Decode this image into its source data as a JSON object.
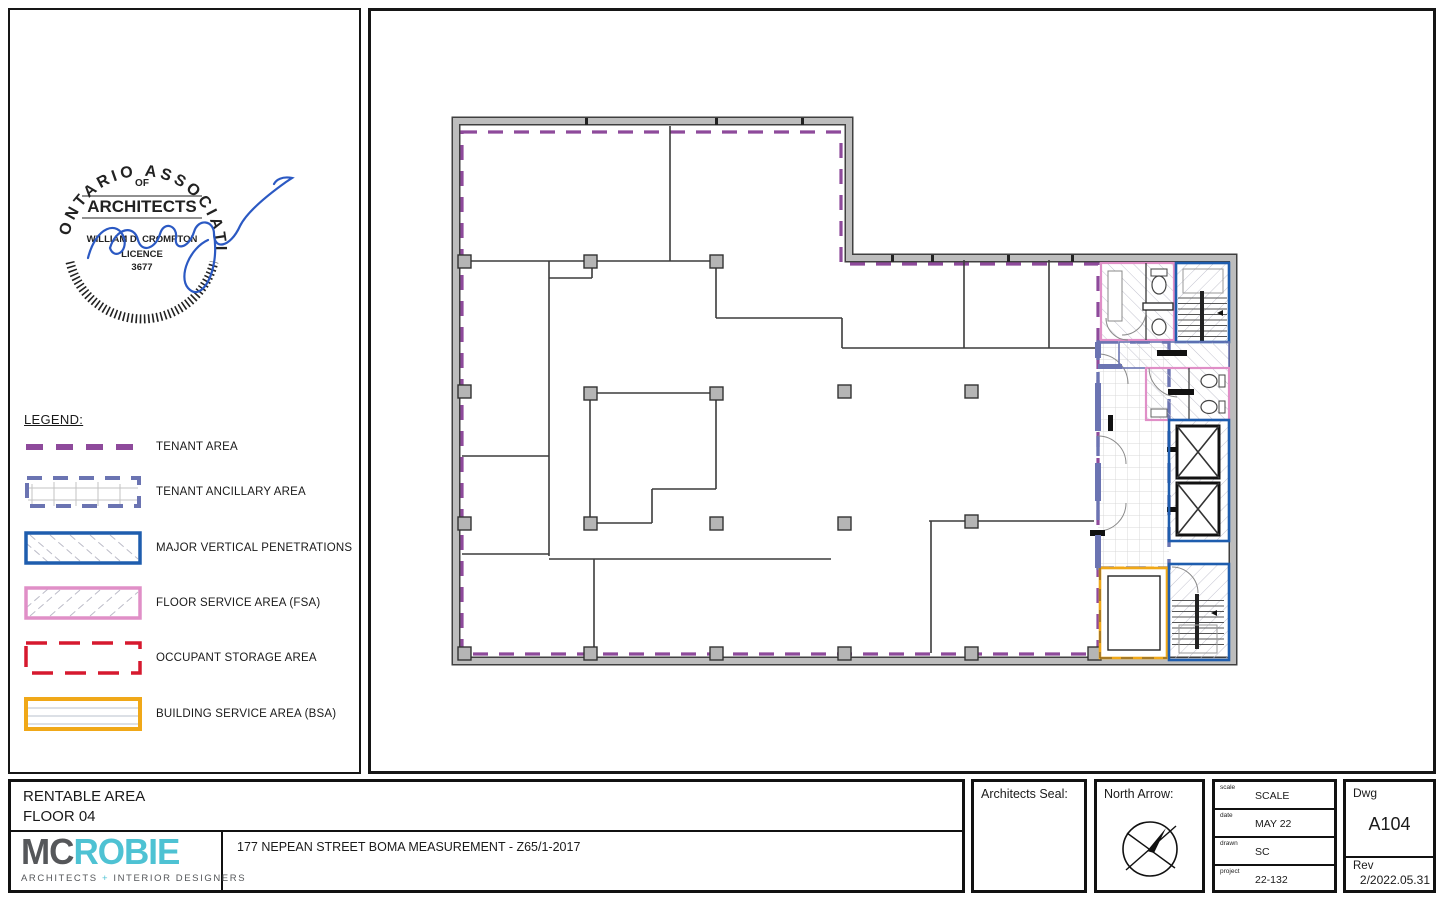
{
  "sheet": {
    "colors": {
      "tenant": "#8e4a9b",
      "ancillary": "#6b74b2",
      "mvp": "#1e5dae",
      "fsa": "#e08fc7",
      "storage": "#d6192e",
      "bsa": "#f0a818",
      "wall_gray": "#bdbdbd",
      "logo_teal": "#4ec2d3",
      "logo_gray": "#55575a"
    },
    "seal": {
      "arc_top": "ONTARIO  ASSOCIATION",
      "of": "OF",
      "architects": "ARCHITECTS",
      "name": "WILLIAM D. CROMPTON",
      "licence_label": "LICENCE",
      "licence_number": "3677"
    },
    "legend": {
      "title": "LEGEND:",
      "items": [
        {
          "label": "TENANT AREA",
          "color": "#8e4a9b"
        },
        {
          "label": "TENANT ANCILLARY AREA",
          "color": "#6b74b2"
        },
        {
          "label": "MAJOR VERTICAL PENETRATIONS",
          "color": "#1e5dae"
        },
        {
          "label": "FLOOR SERVICE AREA (FSA)",
          "color": "#e08fc7"
        },
        {
          "label": "OCCUPANT STORAGE AREA",
          "color": "#d6192e"
        },
        {
          "label": "BUILDING SERVICE AREA (BSA)",
          "color": "#f0a818"
        }
      ]
    },
    "titleblock": {
      "drawing_title_line1": "RENTABLE AREA",
      "drawing_title_line2": "FLOOR 04",
      "firm": {
        "logo_primary": "MC",
        "logo_secondary": "ROBIE",
        "tagline_part1": "ARCHITECTS",
        "tagline_plus": "+",
        "tagline_part2": "INTERIOR DESIGNERS"
      },
      "project_title": "177 NEPEAN STREET BOMA MEASUREMENT - Z65/1-2017",
      "architects_seal_label": "Architects Seal:",
      "north_arrow_label": "North Arrow:",
      "info_rows": [
        {
          "key": "scale",
          "value": "SCALE"
        },
        {
          "key": "date",
          "value": "MAY 22"
        },
        {
          "key": "drawn",
          "value": "SC"
        },
        {
          "key": "project",
          "value": "22-132"
        }
      ],
      "dwg_label": "Dwg",
      "dwg_number": "A104",
      "rev_label": "Rev",
      "rev_value": "2/2022.05.31"
    }
  }
}
